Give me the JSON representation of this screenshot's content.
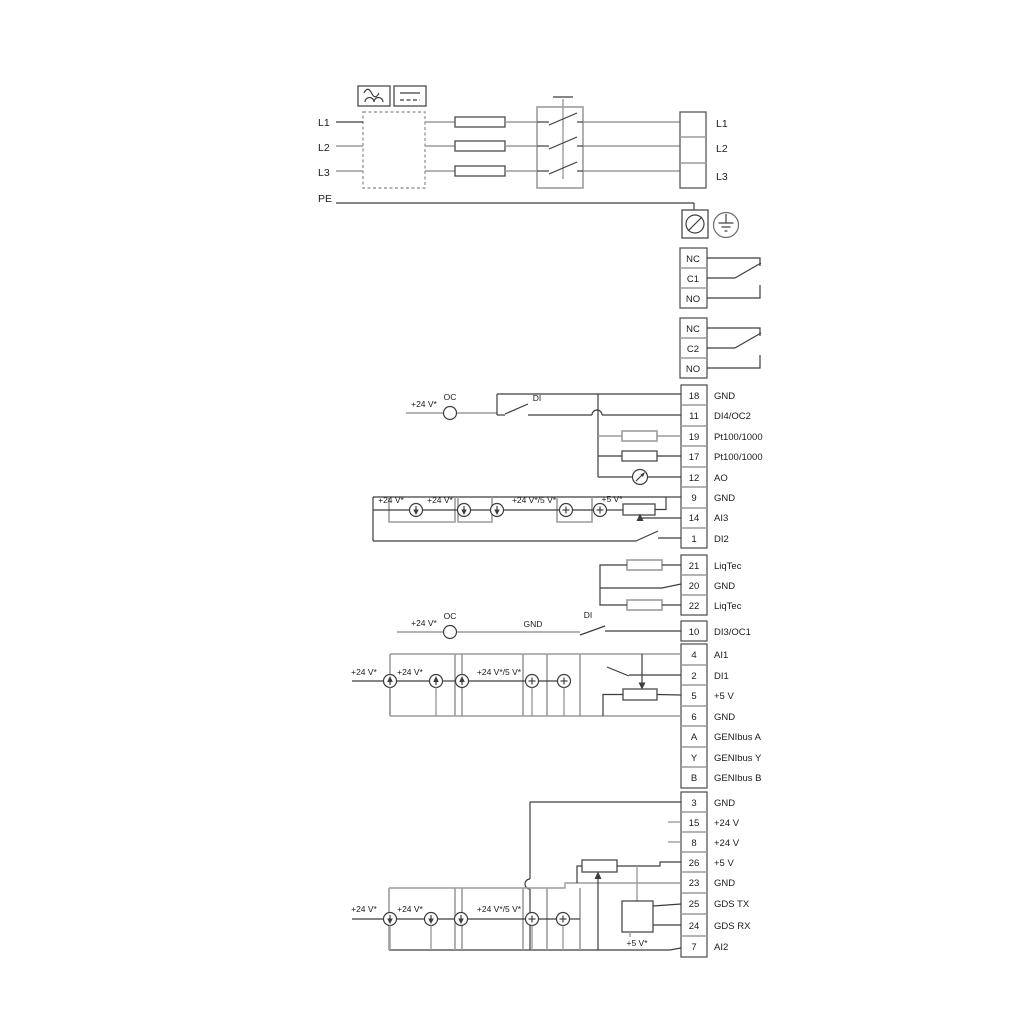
{
  "colors": {
    "wire_dark": "#3d3d3d",
    "wire_gray": "#9c9c9c",
    "text": "#1b1b1b",
    "background": "#ffffff"
  },
  "power": {
    "left_labels": {
      "l1": "L1",
      "l2": "L2",
      "l3": "L3",
      "pe": "PE"
    },
    "right_labels": {
      "l1": "L1",
      "l2": "L2",
      "l3": "L3"
    },
    "icons": {
      "ac": "ac-wave-symbol",
      "dc": "dc-line-symbol",
      "filter": "dashed-converter-box",
      "fuses": 3,
      "switch": "3-pole-main-switch",
      "earth": "protective-earth"
    }
  },
  "relay1": {
    "rows": [
      "NC",
      "C1",
      "NO"
    ]
  },
  "relay2": {
    "rows": [
      "NC",
      "C2",
      "NO"
    ]
  },
  "stripB": {
    "rows": [
      {
        "n": "18",
        "l": "GND"
      },
      {
        "n": "11",
        "l": "DI4/OC2"
      },
      {
        "n": "19",
        "l": "Pt100/1000"
      },
      {
        "n": "17",
        "l": "Pt100/1000"
      },
      {
        "n": "12",
        "l": "AO"
      },
      {
        "n": "9",
        "l": "GND"
      },
      {
        "n": "14",
        "l": "AI3"
      },
      {
        "n": "1",
        "l": "DI2"
      }
    ]
  },
  "stripC": {
    "rows": [
      {
        "n": "21",
        "l": "LiqTec"
      },
      {
        "n": "20",
        "l": "GND"
      },
      {
        "n": "22",
        "l": "LiqTec"
      }
    ]
  },
  "stripD1": {
    "rows": [
      {
        "n": "10",
        "l": "DI3/OC1"
      }
    ]
  },
  "stripD2": {
    "rows": [
      {
        "n": "4",
        "l": "AI1"
      },
      {
        "n": "2",
        "l": "DI1"
      },
      {
        "n": "5",
        "l": "+5 V"
      },
      {
        "n": "6",
        "l": "GND"
      },
      {
        "n": "A",
        "l": "GENIbus A"
      },
      {
        "n": "Y",
        "l": "GENIbus Y"
      },
      {
        "n": "B",
        "l": "GENIbus B"
      }
    ]
  },
  "stripE": {
    "rows": [
      {
        "n": "3",
        "l": "GND"
      },
      {
        "n": "15",
        "l": "+24 V"
      },
      {
        "n": "8",
        "l": "+24 V"
      },
      {
        "n": "26",
        "l": "+5 V"
      },
      {
        "n": "23",
        "l": "GND"
      },
      {
        "n": "25",
        "l": "GDS TX"
      },
      {
        "n": "24",
        "l": "GDS RX"
      },
      {
        "n": "7",
        "l": "AI2"
      }
    ]
  },
  "labels": {
    "v24": "+24 V*",
    "oc": "OC",
    "di": "DI",
    "gnd": "GND",
    "v24_5": "+24 V*/5 V*",
    "v5": "+5 V*"
  }
}
